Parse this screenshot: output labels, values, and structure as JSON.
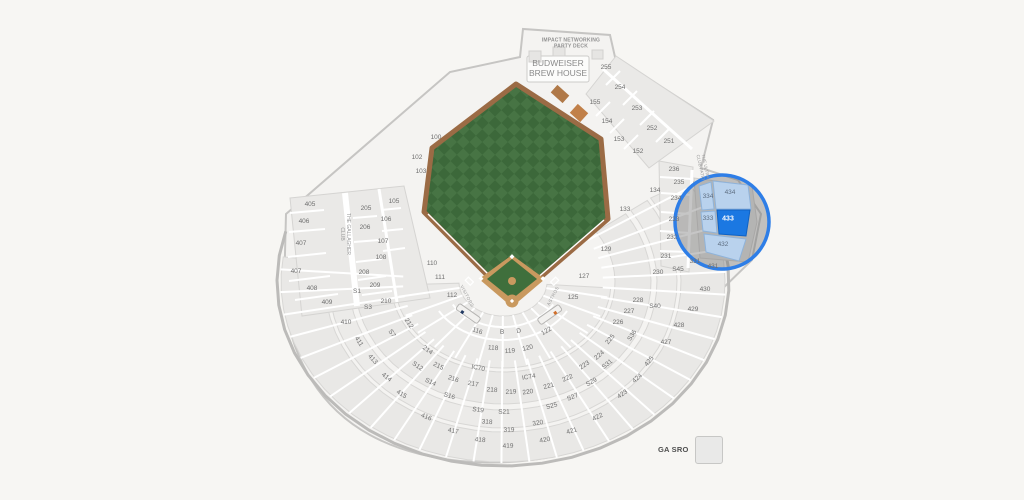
{
  "venue_labels": {
    "party_deck_l1": "IMPACT NETWORKING",
    "party_deck_l2": "PARTY DECK",
    "brew_l1": "BUDWEISER",
    "brew_l2": "BREW HOUSE",
    "gallagher_l1": "THE GALLAGHER",
    "gallagher_l2": "CLUB",
    "ultra_l1": "THE ULTRA",
    "ultra_l2": "CLUB PATIO",
    "dugout_left": "VISITORS",
    "dugout_right": "ASTROS"
  },
  "legend": {
    "label": "GA SRO"
  },
  "highlight": {
    "selected_section": "433",
    "related_sections": [
      "434",
      "334",
      "333",
      "432"
    ],
    "ring_color": "#2e7ee7",
    "selected_fill": "#1b78e2",
    "related_fill": "#b9d2ed"
  },
  "colors": {
    "field_green_a": "#477444",
    "field_green_b": "#3c683a",
    "infield_dirt": "#c9995f",
    "warning_track": "#9b6b45",
    "legend_swatch": "#e9e9e8"
  },
  "sections": [
    {
      "l": "100",
      "x": 436,
      "y": 138
    },
    {
      "l": "102",
      "x": 417,
      "y": 158
    },
    {
      "l": "103",
      "x": 421,
      "y": 172
    },
    {
      "l": "105",
      "x": 394,
      "y": 202
    },
    {
      "l": "106",
      "x": 386,
      "y": 220
    },
    {
      "l": "107",
      "x": 383,
      "y": 242
    },
    {
      "l": "108",
      "x": 381,
      "y": 258
    },
    {
      "l": "110",
      "x": 432,
      "y": 264
    },
    {
      "l": "111",
      "x": 440,
      "y": 278
    },
    {
      "l": "112",
      "x": 452,
      "y": 296
    },
    {
      "l": "116",
      "x": 477,
      "y": 332
    },
    {
      "l": "118",
      "x": 493,
      "y": 349
    },
    {
      "l": "119",
      "x": 510,
      "y": 352
    },
    {
      "l": "120",
      "x": 528,
      "y": 349
    },
    {
      "l": "122",
      "x": 547,
      "y": 332
    },
    {
      "l": "125",
      "x": 573,
      "y": 298
    },
    {
      "l": "127",
      "x": 584,
      "y": 277
    },
    {
      "l": "129",
      "x": 606,
      "y": 250
    },
    {
      "l": "133",
      "x": 625,
      "y": 210
    },
    {
      "l": "134",
      "x": 655,
      "y": 191
    },
    {
      "l": "B",
      "x": 502,
      "y": 333
    },
    {
      "l": "D",
      "x": 519,
      "y": 332
    },
    {
      "l": "IC70",
      "x": 478,
      "y": 369
    },
    {
      "l": "IC74",
      "x": 529,
      "y": 378
    },
    {
      "l": "152",
      "x": 638,
      "y": 152
    },
    {
      "l": "153",
      "x": 619,
      "y": 140
    },
    {
      "l": "154",
      "x": 607,
      "y": 122
    },
    {
      "l": "155",
      "x": 595,
      "y": 103
    },
    {
      "l": "205",
      "x": 366,
      "y": 209
    },
    {
      "l": "206",
      "x": 365,
      "y": 228
    },
    {
      "l": "208",
      "x": 364,
      "y": 273
    },
    {
      "l": "209",
      "x": 375,
      "y": 286
    },
    {
      "l": "210",
      "x": 386,
      "y": 302
    },
    {
      "l": "212",
      "x": 408,
      "y": 324
    },
    {
      "l": "214",
      "x": 427,
      "y": 351
    },
    {
      "l": "215",
      "x": 438,
      "y": 367
    },
    {
      "l": "216",
      "x": 453,
      "y": 380
    },
    {
      "l": "217",
      "x": 473,
      "y": 385
    },
    {
      "l": "218",
      "x": 492,
      "y": 391
    },
    {
      "l": "219",
      "x": 511,
      "y": 393
    },
    {
      "l": "220",
      "x": 528,
      "y": 393
    },
    {
      "l": "221",
      "x": 549,
      "y": 387
    },
    {
      "l": "222",
      "x": 568,
      "y": 379
    },
    {
      "l": "223",
      "x": 585,
      "y": 366
    },
    {
      "l": "224",
      "x": 600,
      "y": 356
    },
    {
      "l": "225",
      "x": 611,
      "y": 340
    },
    {
      "l": "226",
      "x": 618,
      "y": 323
    },
    {
      "l": "227",
      "x": 629,
      "y": 312
    },
    {
      "l": "228",
      "x": 638,
      "y": 301
    },
    {
      "l": "230",
      "x": 658,
      "y": 273
    },
    {
      "l": "231",
      "x": 666,
      "y": 257
    },
    {
      "l": "232",
      "x": 672,
      "y": 238
    },
    {
      "l": "233",
      "x": 674,
      "y": 220
    },
    {
      "l": "234",
      "x": 676,
      "y": 199
    },
    {
      "l": "235",
      "x": 679,
      "y": 183
    },
    {
      "l": "236",
      "x": 674,
      "y": 170
    },
    {
      "l": "251",
      "x": 669,
      "y": 142
    },
    {
      "l": "252",
      "x": 652,
      "y": 129
    },
    {
      "l": "253",
      "x": 637,
      "y": 109
    },
    {
      "l": "254",
      "x": 620,
      "y": 88
    },
    {
      "l": "255",
      "x": 606,
      "y": 68
    },
    {
      "l": "318",
      "x": 487,
      "y": 423
    },
    {
      "l": "319",
      "x": 509,
      "y": 431
    },
    {
      "l": "320",
      "x": 538,
      "y": 424
    },
    {
      "l": "331",
      "x": 695,
      "y": 262
    },
    {
      "l": "333",
      "x": 708,
      "y": 219,
      "cls": "rel"
    },
    {
      "l": "334",
      "x": 708,
      "y": 197,
      "cls": "rel"
    },
    {
      "l": "405",
      "x": 310,
      "y": 205
    },
    {
      "l": "406",
      "x": 304,
      "y": 222
    },
    {
      "l": "407",
      "x": 301,
      "y": 244
    },
    {
      "l": "407",
      "x": 296,
      "y": 272
    },
    {
      "l": "408",
      "x": 312,
      "y": 289
    },
    {
      "l": "409",
      "x": 327,
      "y": 303
    },
    {
      "l": "410",
      "x": 346,
      "y": 323
    },
    {
      "l": "411",
      "x": 358,
      "y": 342
    },
    {
      "l": "413",
      "x": 372,
      "y": 360
    },
    {
      "l": "414",
      "x": 386,
      "y": 378
    },
    {
      "l": "415",
      "x": 401,
      "y": 395
    },
    {
      "l": "416",
      "x": 426,
      "y": 418
    },
    {
      "l": "417",
      "x": 453,
      "y": 432
    },
    {
      "l": "418",
      "x": 480,
      "y": 441
    },
    {
      "l": "419",
      "x": 508,
      "y": 447
    },
    {
      "l": "420",
      "x": 545,
      "y": 441
    },
    {
      "l": "421",
      "x": 572,
      "y": 432
    },
    {
      "l": "422",
      "x": 598,
      "y": 418
    },
    {
      "l": "423",
      "x": 623,
      "y": 395
    },
    {
      "l": "424",
      "x": 638,
      "y": 379
    },
    {
      "l": "425",
      "x": 650,
      "y": 362
    },
    {
      "l": "427",
      "x": 666,
      "y": 343
    },
    {
      "l": "428",
      "x": 679,
      "y": 326
    },
    {
      "l": "429",
      "x": 693,
      "y": 310
    },
    {
      "l": "430",
      "x": 705,
      "y": 290
    },
    {
      "l": "431",
      "x": 713,
      "y": 267
    },
    {
      "l": "432",
      "x": 723,
      "y": 245,
      "cls": "rel"
    },
    {
      "l": "433",
      "x": 728,
      "y": 219,
      "cls": "sel"
    },
    {
      "l": "434",
      "x": 730,
      "y": 193,
      "cls": "rel"
    },
    {
      "l": "S1",
      "x": 357,
      "y": 292
    },
    {
      "l": "S3",
      "x": 368,
      "y": 308
    },
    {
      "l": "S7",
      "x": 391,
      "y": 334
    },
    {
      "l": "S12",
      "x": 417,
      "y": 367
    },
    {
      "l": "S14",
      "x": 430,
      "y": 383
    },
    {
      "l": "S16",
      "x": 449,
      "y": 397
    },
    {
      "l": "S19",
      "x": 478,
      "y": 411
    },
    {
      "l": "S21",
      "x": 504,
      "y": 413
    },
    {
      "l": "S25",
      "x": 552,
      "y": 407
    },
    {
      "l": "S27",
      "x": 573,
      "y": 398
    },
    {
      "l": "S29",
      "x": 592,
      "y": 383
    },
    {
      "l": "S31",
      "x": 608,
      "y": 365
    },
    {
      "l": "S36",
      "x": 633,
      "y": 336
    },
    {
      "l": "S40",
      "x": 655,
      "y": 307
    },
    {
      "l": "S45",
      "x": 678,
      "y": 270
    }
  ]
}
